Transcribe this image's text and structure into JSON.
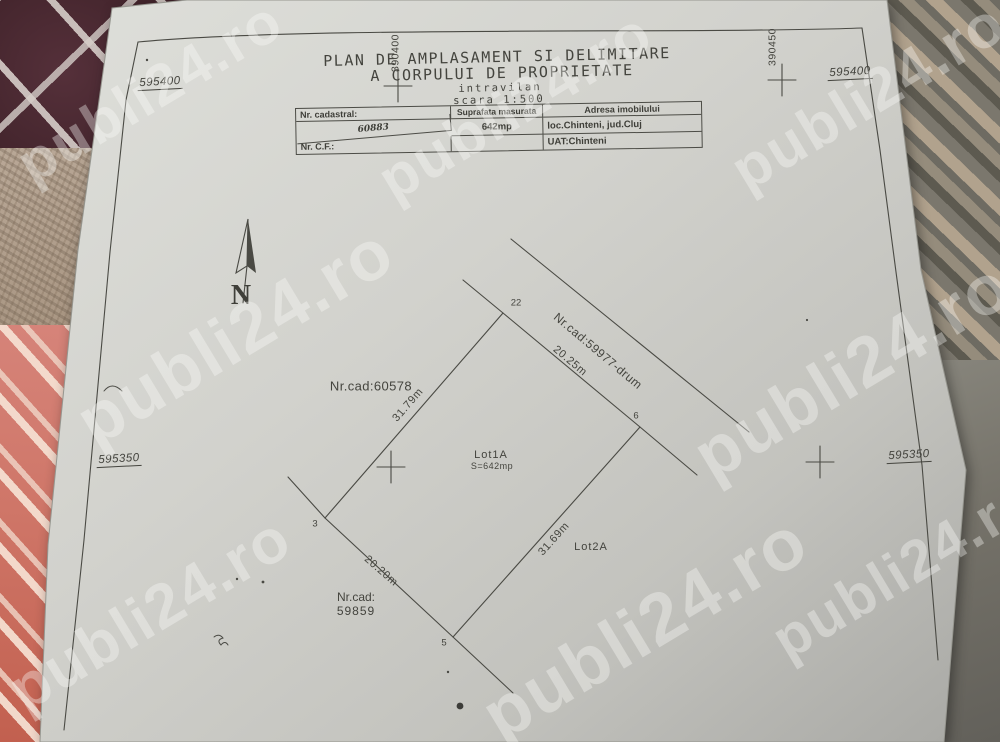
{
  "title": {
    "line1": "PLAN DE AMPLASAMENT SI DELIMITARE",
    "line2": "A CORPULUI DE PROPRIETATE",
    "line3": "intravilan",
    "line4": "scara 1:500"
  },
  "table": {
    "nr_cadastral_label": "Nr. cadastral:",
    "nr_cadastral_value": "60883",
    "suprafata_label": "Suprafata masurata",
    "suprafata_value": "642mp",
    "adresa_label": "Adresa imobilului",
    "adresa_value": "loc.Chinteni, jud.Cluj",
    "nr_cf_label": "Nr. C.F.:",
    "nr_cf_value": "",
    "uat_value": "UAT:Chinteni"
  },
  "grid": {
    "easting_top_left": "595400",
    "easting_top_right": "595400",
    "easting_mid_left": "595350",
    "easting_mid_right": "595350",
    "northing_top": "390400",
    "northing_top_right": "390450"
  },
  "north_label": "N",
  "parcel": {
    "vertex_top": "22",
    "vertex_right": "6",
    "vertex_left": "3",
    "vertex_bottom": "5",
    "dim_top_right": "20.25m",
    "dim_top_left": "31.79m",
    "dim_bottom_left": "20.20m",
    "dim_bottom_right": "31.69m",
    "lot1_name": "Lot1A",
    "lot1_area": "S=642mp",
    "lot2_name": "Lot2A",
    "neighbor_left": "Nr.cad:60578",
    "road": "Nr.cad:59977-drum",
    "neighbor_bottom_line1": "Nr.cad:",
    "neighbor_bottom_line2": "59859"
  },
  "watermark": {
    "text": "publi24.ro"
  },
  "colors": {
    "paper": "#d2d2cd",
    "ink": "#44443e",
    "watermark_tint": "#fcfcfa"
  }
}
